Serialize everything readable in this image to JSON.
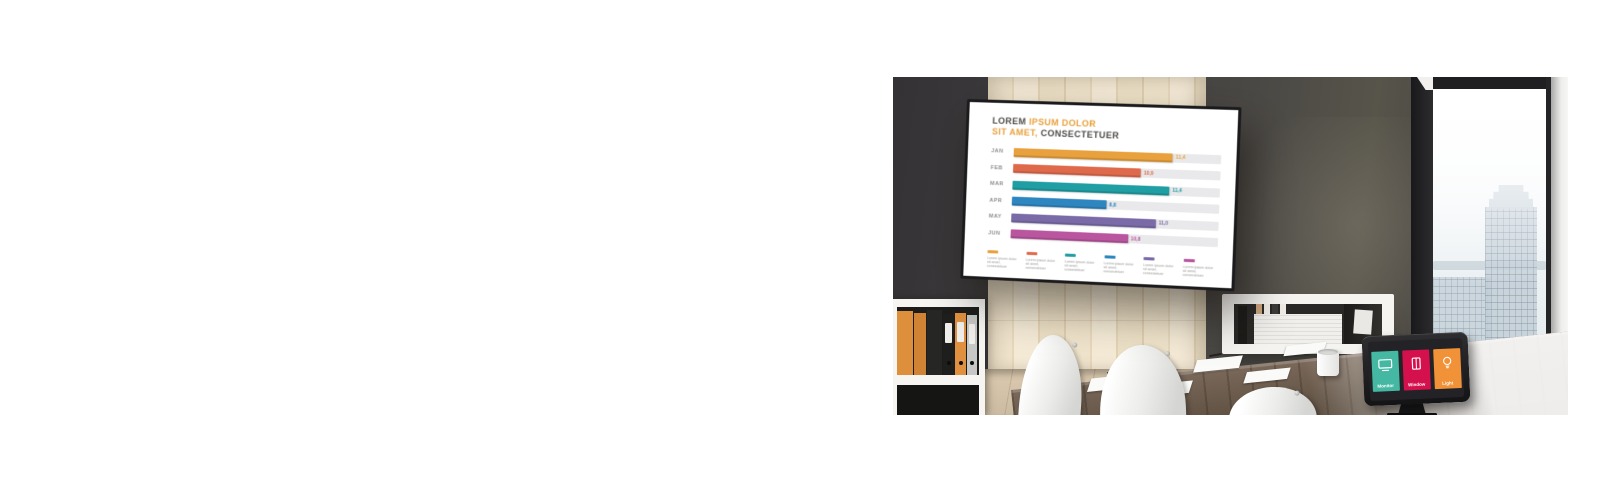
{
  "display": {
    "title": {
      "p1": "LOREM",
      "p2": "IPSUM DOLOR",
      "p3": "SIT AMET,",
      "p4": "CONSECTETUER"
    },
    "accent": "#E8A13C"
  },
  "chart_data": {
    "type": "bar",
    "orientation": "horizontal",
    "title": "LOREM IPSUM DOLOR SIT AMET, CONSECTETUER",
    "categories": [
      "JAN",
      "FEB",
      "MAR",
      "APR",
      "MAY",
      "JUN"
    ],
    "values": [
      11.4,
      10.9,
      11.4,
      8.8,
      11.0,
      10.8
    ],
    "value_labels": [
      "11,4",
      "10,9",
      "11,4",
      "8,8",
      "11,0",
      "10,8"
    ],
    "colors": [
      "#E8A13C",
      "#DF6A4B",
      "#1F9EA3",
      "#2E86C0",
      "#7A6BA8",
      "#B9569F"
    ],
    "bar_pct": [
      77,
      62,
      76,
      46,
      70,
      57
    ],
    "track_color": "#E9E9EB",
    "xlim": [
      0,
      14.5
    ],
    "grid": false,
    "legend": {
      "position": "bottom",
      "label": "Lorem ipsum dolor sit amet, consectetuer"
    }
  },
  "tablet": {
    "tiles": [
      {
        "label": "Monitor",
        "color": "#45B8A3"
      },
      {
        "label": "Window",
        "color": "#D5114D"
      },
      {
        "label": "Light",
        "color": "#F29238"
      }
    ]
  }
}
